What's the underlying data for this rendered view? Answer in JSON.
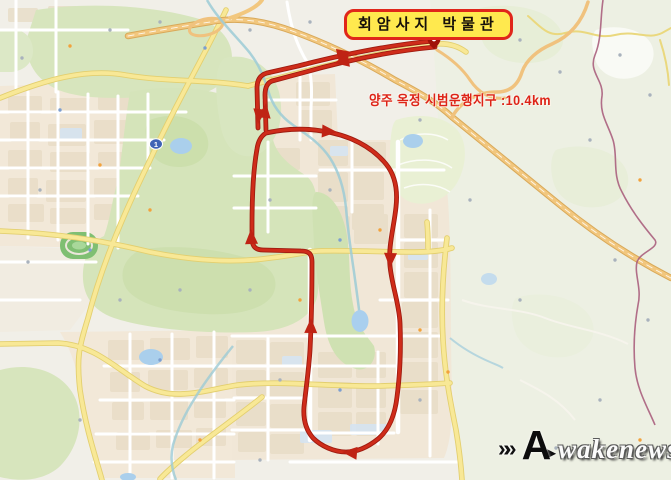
{
  "overlay": {
    "museum_label": "회암사지 박물관",
    "route_caption": "양주 옥정 시범운행지구 :10.4km"
  },
  "route": {
    "name": "양주 옥정 시범운행지구",
    "distance_km": "10.4",
    "destination": "회암사지 박물관",
    "color": "#c8291b",
    "shape": "closed loop through Okjeong district with out-and-back spur northeast to Hoeamsaji Museum",
    "arrow_directions": [
      "northeast-outbound-to-museum",
      "southwest-return",
      "south-return-on-spur",
      "north-outbound-on-spur",
      "east-top-of-loop",
      "south-right-side",
      "west-bottom",
      "north-middle",
      "north-upper-left"
    ]
  },
  "map": {
    "road_shield": "1",
    "colors": {
      "land": "#f1efe8",
      "urban_block": "#f1e7d7",
      "park_green": "#d5e4ba",
      "water": "#aacfec",
      "road_yellow": "#f8e896",
      "highway_orange": "#f2c77e",
      "admin_boundary": "#aa5f7d",
      "route_red": "#c8291b",
      "label_box_bg": "#ffe94e",
      "label_box_border": "#e0261a",
      "caption_red": "#dd2317"
    }
  },
  "watermark": {
    "chevrons": "»»",
    "initial": "A",
    "arrow": "►",
    "text": "wakenews"
  }
}
